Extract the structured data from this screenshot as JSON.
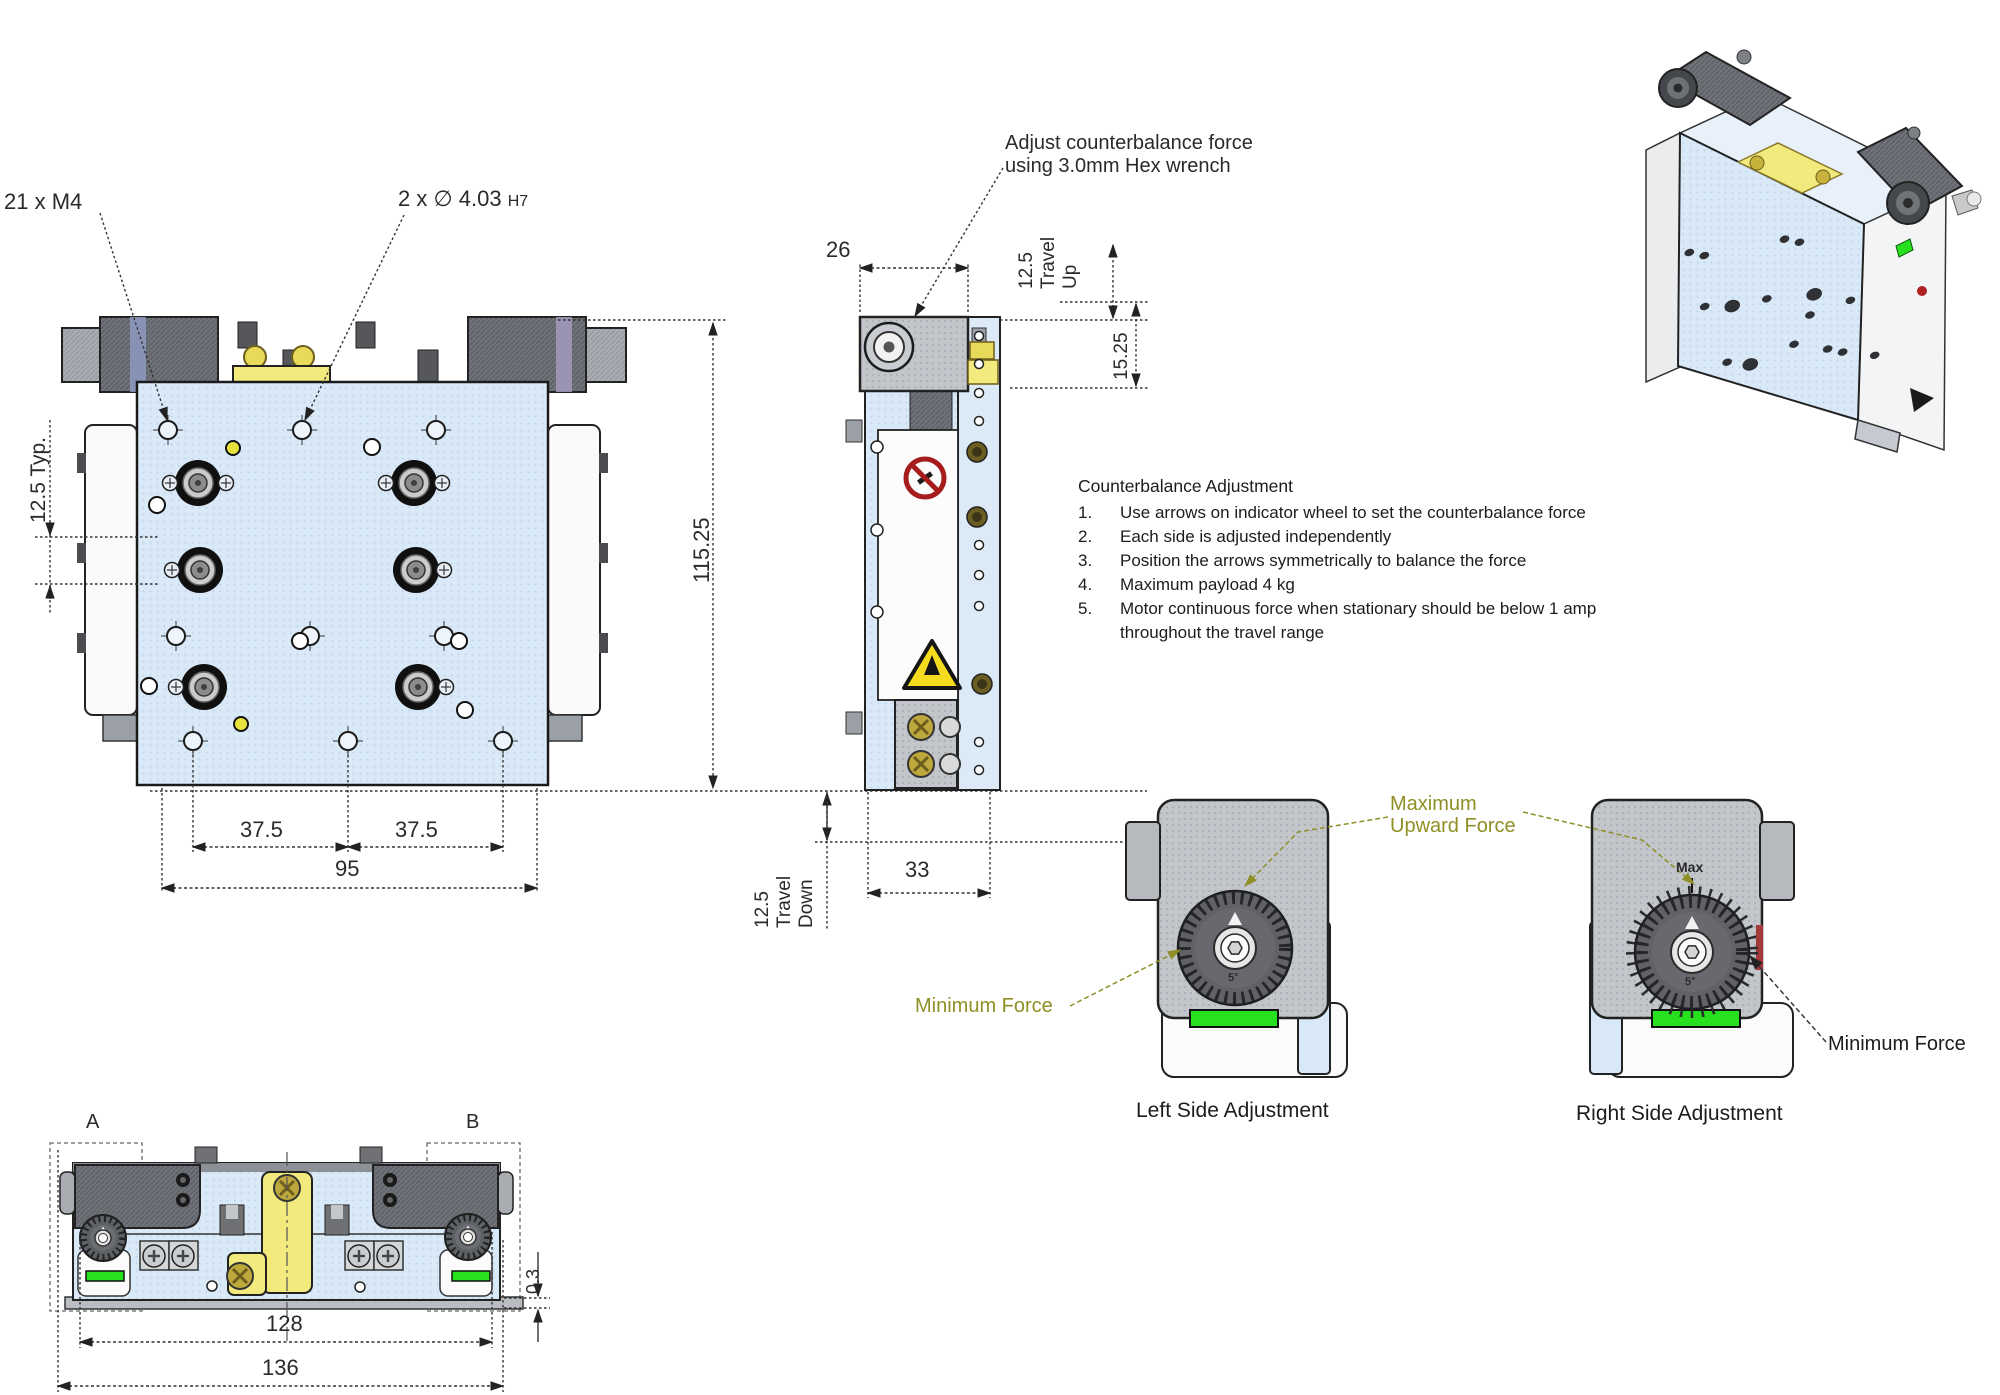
{
  "front": {
    "callout_m4": "21 x M4",
    "callout_pin": "2 x ∅ 4.03",
    "callout_pin_tol": "H7",
    "dim_pitch": "12.5 Typ.",
    "dim_height": "115.25",
    "dim_a": "37.5",
    "dim_b": "37.5",
    "dim_width": "95"
  },
  "side": {
    "callout_line1": "Adjust counterbalance force",
    "callout_line2": "using 3.0mm Hex wrench",
    "dim_top": "26",
    "travel_up_value": "12.5",
    "travel_up_label": "Travel Up",
    "dim_offset": "15.25",
    "dim_depth": "33",
    "travel_down_value": "12.5",
    "travel_down_label": "Travel Down"
  },
  "notes": {
    "title": "Counterbalance Adjustment",
    "items": [
      {
        "num": "1.",
        "text": "Use arrows on indicator wheel to set the counterbalance force"
      },
      {
        "num": "2.",
        "text": "Each side is adjusted independently"
      },
      {
        "num": "3.",
        "text": "Position the arrows symmetrically to balance the force"
      },
      {
        "num": "4.",
        "text": "Maximum payload 4 kg"
      },
      {
        "num": "5.",
        "text": "Motor continuous force when stationary should be below 1 amp throughout the travel range"
      }
    ]
  },
  "adjust": {
    "max_line1": "Maximum",
    "max_line2": "Upward Force",
    "min_left": "Minimum Force",
    "min_right": "Minimum Force",
    "max_tick": "Max",
    "dial_mark": "5°",
    "left_caption": "Left Side Adjustment",
    "right_caption": "Right Side Adjustment"
  },
  "bottom": {
    "label_a": "A",
    "label_b": "B",
    "dim_inner": "128",
    "dim_outer": "136",
    "dim_step": "0.3"
  },
  "colors": {
    "plate_blue": "#d9e9f8",
    "machined_gray": "#c2c6cb",
    "motor_dark": "#707379",
    "accent_yellow": "#f2ea7d",
    "indicator_green": "#27e11f",
    "warning_red": "#a61c1c",
    "warning_yellow": "#f5dc1e",
    "callout_olive": "#8f8f25"
  }
}
